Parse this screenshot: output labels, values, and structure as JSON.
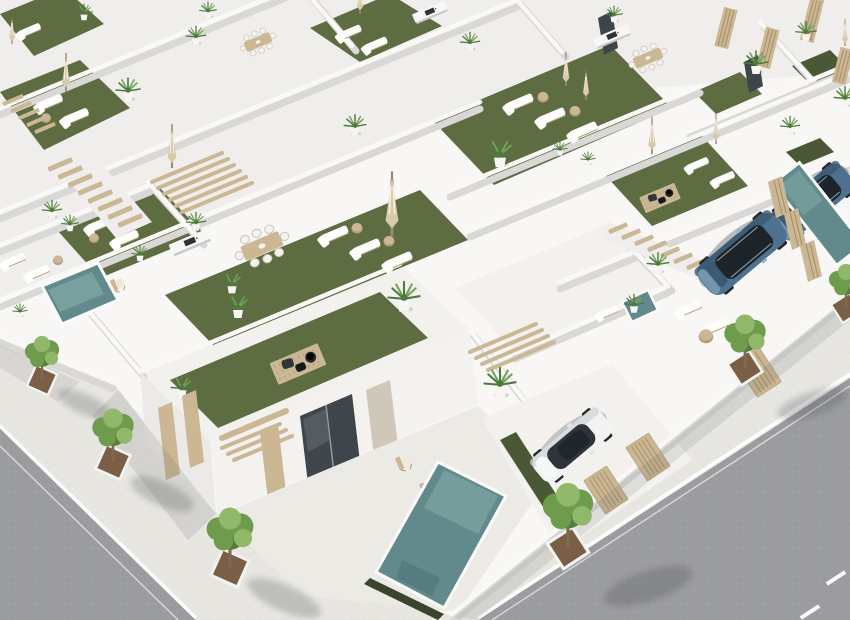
{
  "scene": {
    "type": "architectural-render",
    "description": "High-angle aerial 3D render of a modern white villa development: rows of flat-roofed houses with artificial-turf roof terraces furnished with sun loungers, closed parasols, dining sets and potted palms; street-level plots with small teal pools, a white sedan and two blue SUVs parked in driveways; two tree-lined streets with pale paved sidewalks meet at a corner in the foreground.",
    "time_of_day": "midday",
    "no_text_visible": true
  },
  "inventory": {
    "rooftop_terraces": 9,
    "pools": 4,
    "cars": {
      "white_sedan": 1,
      "blue_suv": 2
    },
    "street_trees": 6,
    "sun_loungers": 21,
    "parasols": 10,
    "dining_sets": 3,
    "deck_rugs": 2,
    "staircases": 3,
    "pergolas": 3,
    "potted_palms": 26,
    "slatted_gates": 6,
    "lane_dashes": 2
  },
  "palette": {
    "base": "#f0efec",
    "roofWhite": "#f8f7f5",
    "roofWhite2": "#f2f1ee",
    "parapet": "#efeeec",
    "wallShade": "#d9d8d6",
    "wallShade2": "#c8c8c7",
    "turf": "#5d6c41",
    "turfDark": "#4b5836",
    "turfLight": "#6d7d4b",
    "pool": "#628a8c",
    "poolLight": "#8fb3b0",
    "poolDark": "#4d7375",
    "poolTrim": "#39452c",
    "wood": "#cbb794",
    "woodDark": "#b29e7b",
    "woodLight": "#dfd2b6",
    "glass": "#3e454b",
    "stone": "#cfc7ba",
    "road": "#9b9c9f",
    "roadDark": "#8d8f92",
    "walk": "#e8e6e1",
    "pot": "#f6f5f2",
    "treeGreen": "#6f9b4c",
    "treeLight": "#8fb868",
    "treeDark": "#557d39",
    "trunk": "#7e6a52",
    "dirt": "#7a5f46",
    "palmGreen": "#4e7a3f",
    "palmLight": "#74a258",
    "umbrella": "#d8c9ab",
    "cushion": "#31363b",
    "fire": "#212426",
    "carWhite": "#f1f3f4",
    "carGlass": "#2e353a",
    "suvBlue": "#4f7190",
    "suvLight": "#7296ad",
    "suvGlass": "#1e252a"
  }
}
